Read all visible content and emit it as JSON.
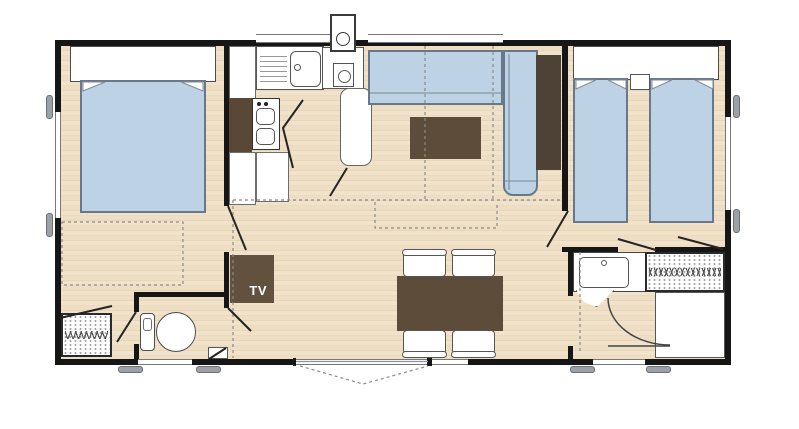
{
  "plan": {
    "title": "mobile-home-floorplan",
    "tv_label": "TV",
    "colors": {
      "wall": "#161616",
      "floor_wood": "#eedec4",
      "bed_sofa_blue": "#bdd2e4",
      "furniture_brown": "#5e4c3b",
      "tall_cabinet_dark": "#4e4136",
      "hardware_gray": "#9ba1a6",
      "linework_gray": "#8a8a8a"
    },
    "rooms": [
      {
        "name": "bedroom-left",
        "furniture": [
          "double-bed",
          "headboard",
          "under-bed-storage-outline",
          "wardrobe-hatch",
          "wc-room"
        ]
      },
      {
        "name": "kitchen",
        "furniture": [
          "sink-with-drainboard",
          "stove-two-burners",
          "counter-cabinets",
          "water-heater",
          "roof-vent",
          "tall-rounded-cabinet"
        ]
      },
      {
        "name": "living-dining",
        "furniture": [
          "l-shaped-sofa",
          "coffee-table",
          "tv-cabinet",
          "dining-table",
          "four-chairs",
          "tall-dark-cabinet",
          "sliding-patio-door"
        ]
      },
      {
        "name": "bedroom-right",
        "furniture": [
          "single-bed-left",
          "single-bed-right",
          "shared-headboard",
          "nightstand"
        ]
      },
      {
        "name": "bathroom",
        "furniture": [
          "washbasin-vanity",
          "shower",
          "storage-hatch-unit",
          "door-swing-arc"
        ]
      }
    ],
    "openings": [
      "left-wall-window",
      "right-wall-window",
      "top-window-over-sink",
      "top-window-over-sofa",
      "bottom-window-wc",
      "bottom-sliding-door",
      "bottom-fixed-window",
      "bottom-window-bathroom"
    ]
  }
}
